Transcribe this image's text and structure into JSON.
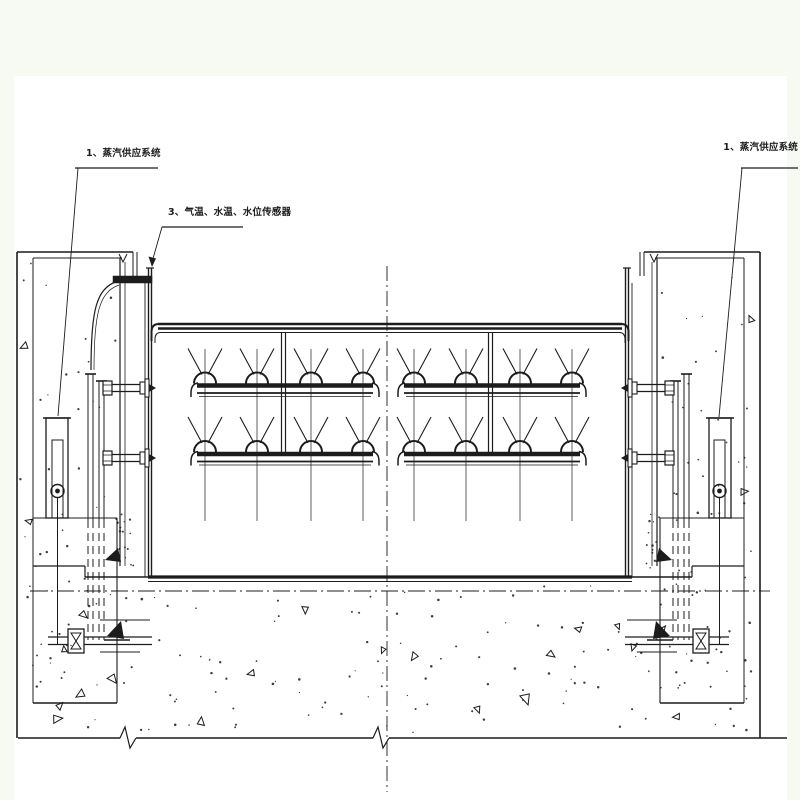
{
  "labels": {
    "steam_left": "1、蒸汽供应系统",
    "sensors": "3、气温、水温、水位传感器",
    "steam_right": "1、蒸汽供应系统"
  },
  "colors": {
    "background": "#f7faf2",
    "paper": "#ffffff",
    "ink": "#1c1c1c"
  }
}
